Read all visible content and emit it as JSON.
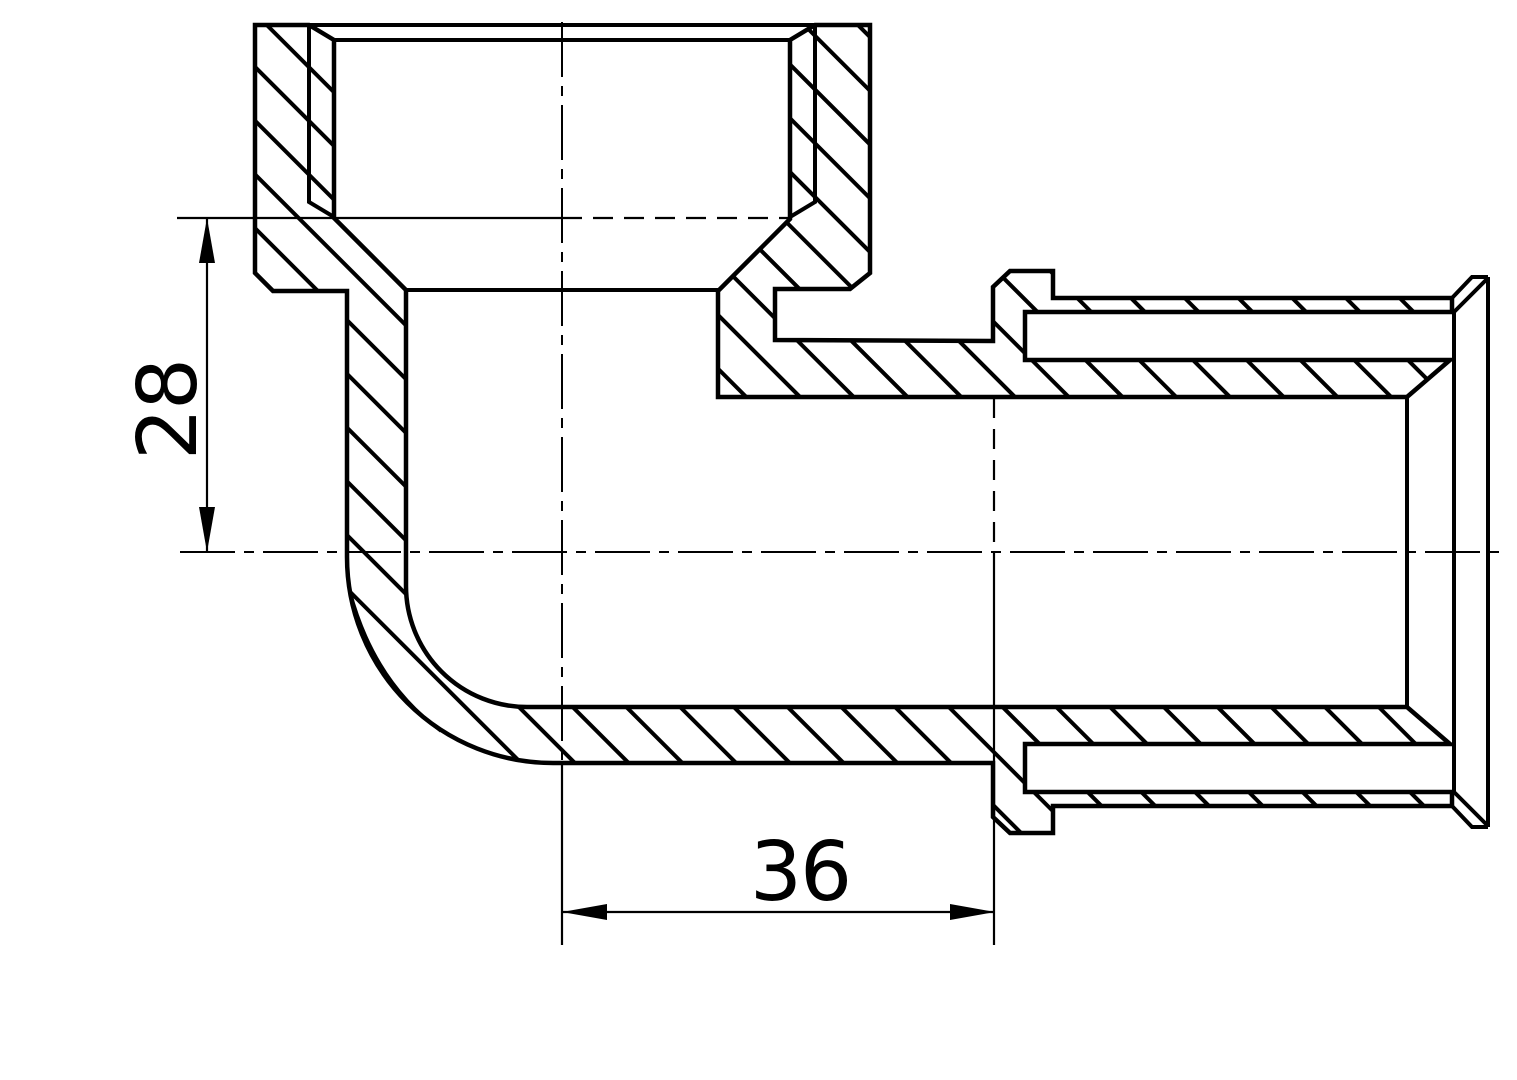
{
  "drawing": {
    "kind": "technical-section-drawing",
    "subject": "90-degree elbow pipe fitting, full section view with hatched cut walls",
    "background_color": "#ffffff",
    "line_color": "#000000",
    "dimensions": {
      "vertical": {
        "value": "28",
        "orientation": "vertical",
        "measures": "distance from socket thread depth to horizontal centerline"
      },
      "horizontal": {
        "value": "36",
        "orientation": "horizontal",
        "measures": "distance from vertical centerline to right socket depth"
      }
    }
  }
}
